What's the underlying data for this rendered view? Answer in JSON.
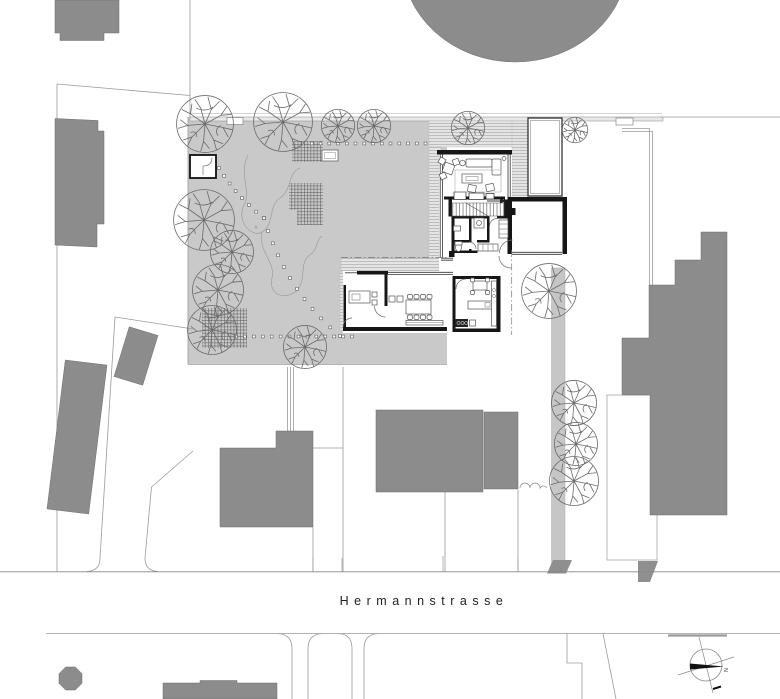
{
  "street": {
    "label": "Hermannstrasse"
  },
  "compass": {
    "label": "N"
  },
  "colors": {
    "building_fill": "#8c8c8c",
    "building_stroke": "#6f6f6f",
    "garden": "#c9c9c9",
    "deck_bg": "#e4e4e4",
    "deck_line": "#adadad",
    "wall": "#161616",
    "glass": "#333333",
    "furniture": "#555555",
    "parcel": "#9a9a9a",
    "tree": "#6a6a6a",
    "driveway": "#c6c6c6",
    "ramp": "#8f8f8f",
    "label": "#222222"
  },
  "site": {
    "trees": [
      [
        205,
        124,
        29
      ],
      [
        283,
        122,
        30
      ],
      [
        338,
        126,
        17
      ],
      [
        374,
        126,
        17
      ],
      [
        468,
        128,
        17
      ],
      [
        575,
        130,
        13
      ],
      [
        204,
        220,
        31
      ],
      [
        232,
        252,
        22
      ],
      [
        218,
        290,
        26
      ],
      [
        212,
        330,
        25
      ],
      [
        305,
        347,
        22
      ],
      [
        549,
        291,
        28
      ],
      [
        574,
        403,
        23
      ],
      [
        576,
        444,
        22
      ],
      [
        574,
        481,
        25
      ]
    ]
  }
}
